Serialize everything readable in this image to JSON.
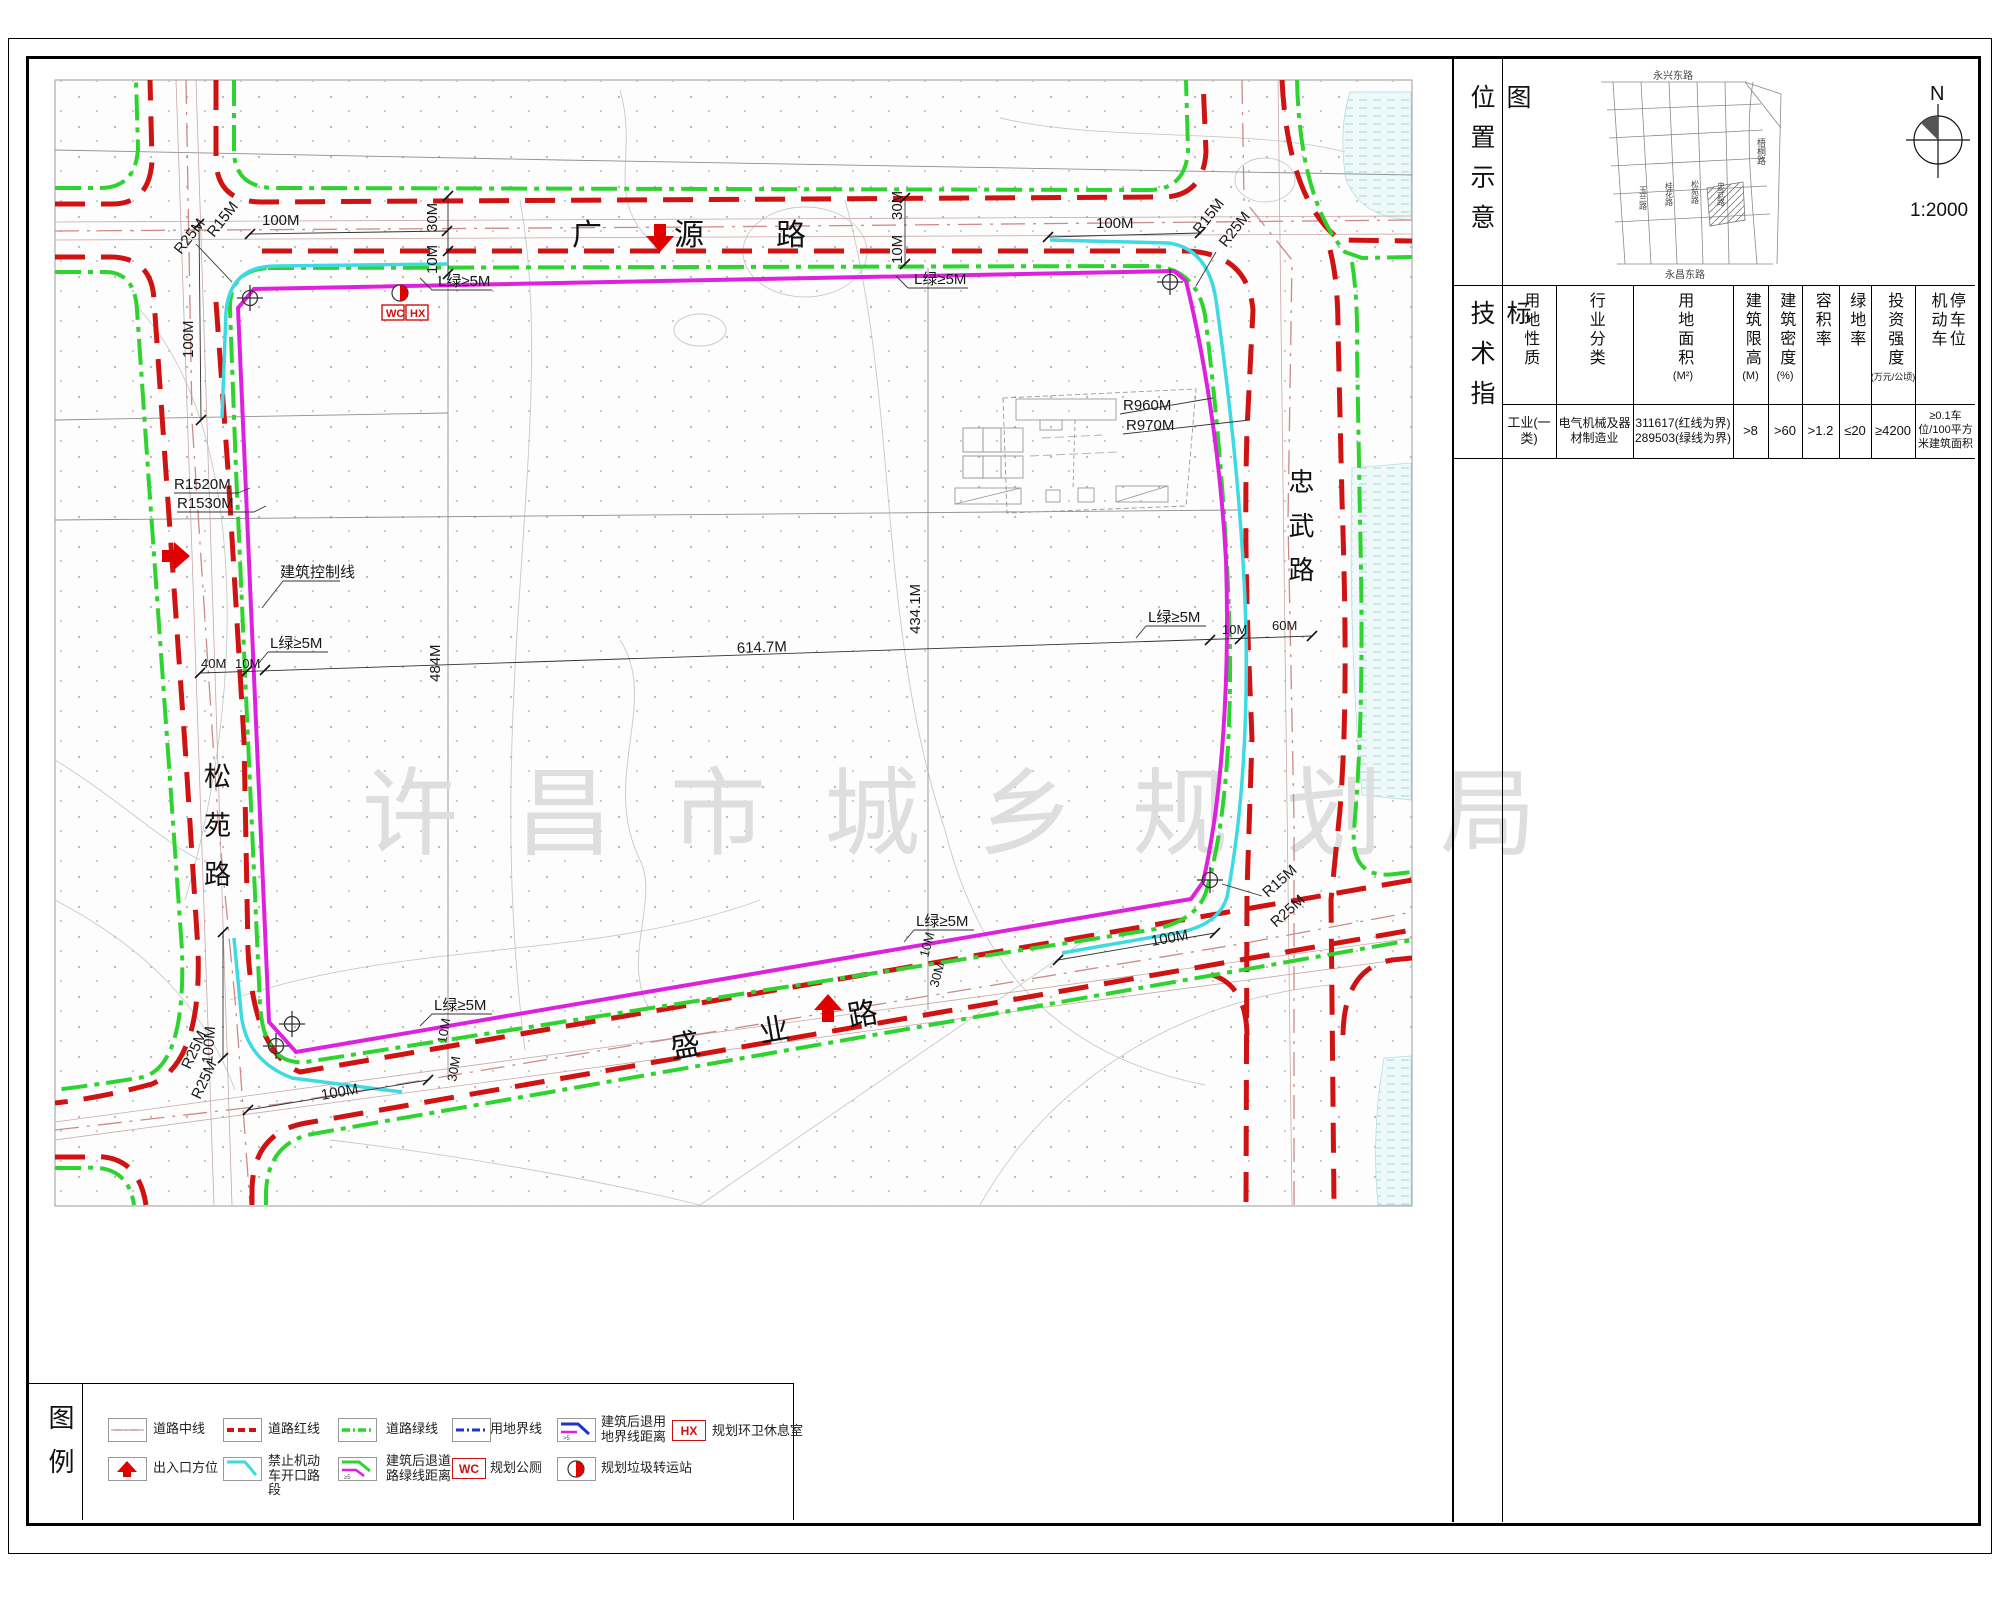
{
  "map": {
    "roads": {
      "top": "广源路",
      "left": "松苑路",
      "right": "忠武路",
      "bottom": "盛业路"
    },
    "watermark": "许昌市城乡规划局",
    "control_line_label": "建筑控制线",
    "wc": "WC",
    "hx": "HX",
    "dims": {
      "m100": "100M",
      "m40": "40M",
      "m30": "30M",
      "m10": "10M",
      "m60": "60M",
      "r15": "R15M",
      "r25": "R25M",
      "r960": "R960M",
      "r970": "R970M",
      "r1520": "R1520M",
      "r1530": "R1530M",
      "d614": "614.7M",
      "d484": "484M",
      "d434": "434.1M",
      "la": "L绿≥5M"
    }
  },
  "panel": {
    "location_label": "位置示意图",
    "tech_label": "技术指标",
    "north": "N",
    "scale": "1:2000",
    "inset_roads": {
      "top": "永兴东路",
      "right": "梧桐路",
      "v1": "玉兰路",
      "v2": "桂花路",
      "v3": "松苑路",
      "v4": "忠武路",
      "bottom": "永昌东路"
    },
    "table": {
      "headers": [
        {
          "t": "用地性质",
          "u": ""
        },
        {
          "t": "行业分类",
          "u": ""
        },
        {
          "t": "用地面积",
          "u": "(M²)"
        },
        {
          "t": "建筑限高",
          "u": "(M)"
        },
        {
          "t": "建筑密度",
          "u": "(%)"
        },
        {
          "t": "容积率",
          "u": ""
        },
        {
          "t": "绿地率",
          "u": ""
        },
        {
          "t": "投资强度",
          "u": "(万元/公顷)"
        },
        {
          "t": "机动车停车位",
          "u": ""
        }
      ],
      "row": [
        "工业(一类)",
        "电气机械及器材制造业",
        "311617(红线为界)\n289503(绿线为界)",
        ">8",
        ">60",
        ">1.2",
        "≤20",
        "≥4200",
        "≥0.1车位/100平方米建筑面积"
      ]
    }
  },
  "legend": {
    "label": "图例",
    "row1": [
      {
        "sym": "road-centerline",
        "label": "道路中线"
      },
      {
        "sym": "road-red-line",
        "label": "道路红线"
      },
      {
        "sym": "road-green-line",
        "label": "道路绿线"
      },
      {
        "sym": "land-boundary",
        "label": "用地界线"
      },
      {
        "sym": "setback-from-boundary",
        "label": "建筑后退用地界线距离"
      },
      {
        "sym": "hx-box",
        "label": "规划环卫休息室"
      }
    ],
    "row2": [
      {
        "sym": "entrance-arrow",
        "label": "出入口方位"
      },
      {
        "sym": "no-opening-segment",
        "label": "禁止机动车开口路段"
      },
      {
        "sym": "setback-from-greenline",
        "label": "建筑后退道路绿线距离"
      },
      {
        "sym": "wc-box",
        "label": "规划公厕"
      },
      {
        "sym": "garbage-station",
        "label": "规划垃圾转运站"
      }
    ]
  },
  "colors": {
    "road_red": "#cf1212",
    "road_green": "#2fd32f",
    "parcel_magenta": "#dd22dd",
    "no_open_cyan": "#3fd9e2",
    "boundary_blue": "#2233cc",
    "arrow_red": "#e00000",
    "watermark_gray": "#dedede"
  }
}
